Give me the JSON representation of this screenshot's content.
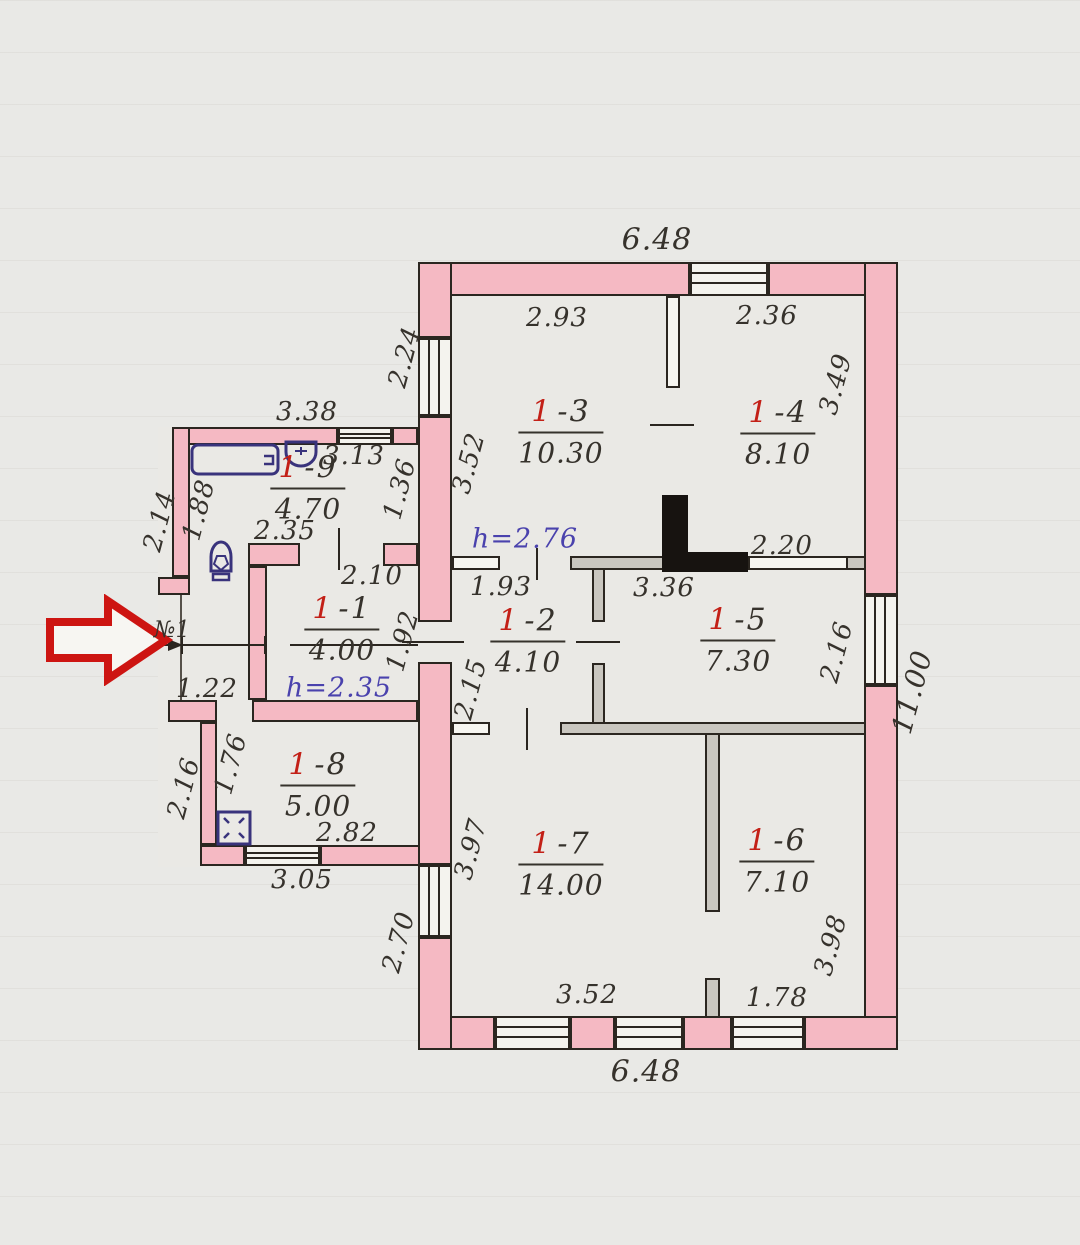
{
  "rooms": {
    "r1": {
      "num": "1",
      "sep": "-1",
      "area": "4.00"
    },
    "r2": {
      "num": "1",
      "sep": "-2",
      "area": "4.10"
    },
    "r3": {
      "num": "1",
      "sep": "-3",
      "area": "10.30"
    },
    "r4": {
      "num": "1",
      "sep": "-4",
      "area": "8.10"
    },
    "r5": {
      "num": "1",
      "sep": "-5",
      "area": "7.30"
    },
    "r6": {
      "num": "1",
      "sep": "-6",
      "area": "7.10"
    },
    "r7": {
      "num": "1",
      "sep": "-7",
      "area": "14.00"
    },
    "r8": {
      "num": "1",
      "sep": "-8",
      "area": "5.00"
    },
    "r9": {
      "num": "1",
      "sep": "-9",
      "area": "4.70"
    }
  },
  "heights": {
    "upper": "h=2.76",
    "lower": "h=2.35"
  },
  "entry": {
    "label": "№1"
  },
  "dims": {
    "top_width": "6.48",
    "bottom_width": "6.48",
    "right_height": "11.00",
    "left_window": "2.24",
    "r3_width": "2.93",
    "r3_depth": "3.52",
    "r4_width": "2.36",
    "r4_depth": "3.49",
    "r9_top": "3.38",
    "r9_inner": "3.13",
    "r9_nook": "1.36",
    "r9_bottom": "2.35",
    "r9_left_outer": "2.14",
    "r9_left_inner": "1.88",
    "r1_width": "2.10",
    "r1_depth": "1.92",
    "entry_width": "1.22",
    "r2_width": "1.93",
    "r2_depth": "2.15",
    "r5_width": "3.36",
    "r5_wall": "2.20",
    "r5_depth": "2.16",
    "r7_depth": "3.97",
    "r7_width": "3.52",
    "r6_depth": "3.98",
    "r6_width": "1.78",
    "bottom_left_height": "2.70",
    "r8_left_inner": "1.76",
    "r8_left_outer": "2.16",
    "r8_width_inner": "2.82",
    "r8_width_outer": "3.05"
  }
}
